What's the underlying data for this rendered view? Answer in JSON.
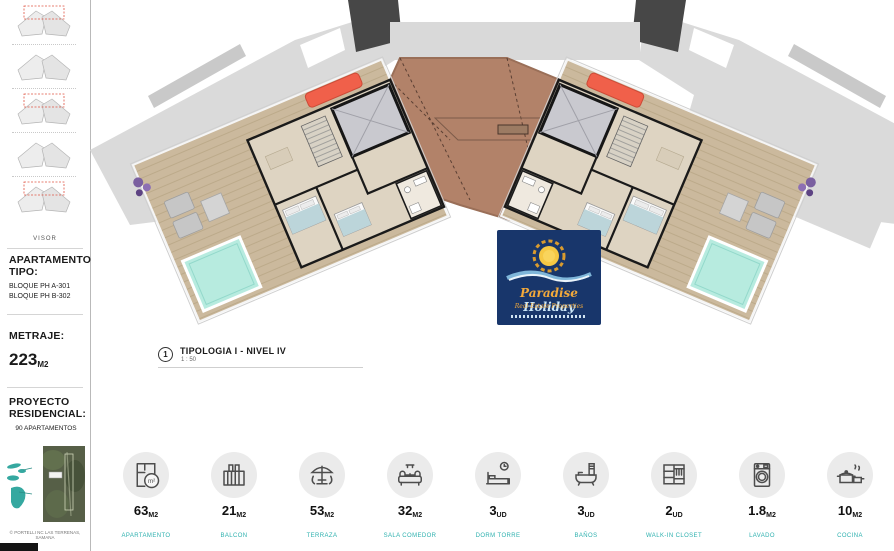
{
  "sidebar": {
    "visor_label": "VISOR",
    "apartamento": {
      "heading": "APARTAMENTO TIPO:",
      "bloque_a": "BLOQUE PH A-301",
      "bloque_b": "BLOQUE PH B-302"
    },
    "metraje": {
      "heading": "METRAJE:",
      "value": "223",
      "unit": "M2"
    },
    "proyecto": {
      "heading": "PROYECTO RESIDENCIAL:",
      "value": "90 APARTAMENTOS"
    },
    "copyright": "© PORTELLI NC LAS TERRENAS, SAMANA"
  },
  "plan": {
    "marker": "1",
    "title": "TIPOLOGIA I - NIVEL IV",
    "scale": "1 : 50"
  },
  "logo": {
    "brand_word_1": "Paradise",
    "brand_word_2": "Holiday",
    "subtitle": "Real Estate Properties"
  },
  "legend": {
    "items": [
      {
        "value": "63",
        "unit": "M2",
        "label": "APARTAMENTO",
        "icon": "floorplan-icon",
        "badge": "m²"
      },
      {
        "value": "21",
        "unit": "M2",
        "label": "BALCON",
        "icon": "balcony-icon"
      },
      {
        "value": "53",
        "unit": "M2",
        "label": "TERRAZA",
        "icon": "terrace-umbrella-icon"
      },
      {
        "value": "32",
        "unit": "M2",
        "label": "SALA COMEDOR",
        "icon": "sofa-icon"
      },
      {
        "value": "3",
        "unit": "UD",
        "label": "DORM TORRE",
        "icon": "bed-clock-icon"
      },
      {
        "value": "3",
        "unit": "UD",
        "label": "BAÑOS",
        "icon": "bathtub-icon"
      },
      {
        "value": "2",
        "unit": "UD",
        "label": "WALK-IN CLOSET",
        "icon": "closet-icon"
      },
      {
        "value": "1.8",
        "unit": "M2",
        "label": "LAVADO",
        "icon": "washer-icon"
      },
      {
        "value": "10",
        "unit": "M2",
        "label": "COCINA",
        "icon": "cookware-icon"
      }
    ]
  },
  "colors": {
    "roof_brown": "#b28269",
    "deck_tan": "#cbb99d",
    "unit_floor": "#ded4c2",
    "pool_cyan": "#b7ebdf",
    "sofa_red": "#f0604a",
    "silhouette_gray": "#dadada",
    "accent_teal": "#2fb1af",
    "logo_navy": "#18366b"
  }
}
